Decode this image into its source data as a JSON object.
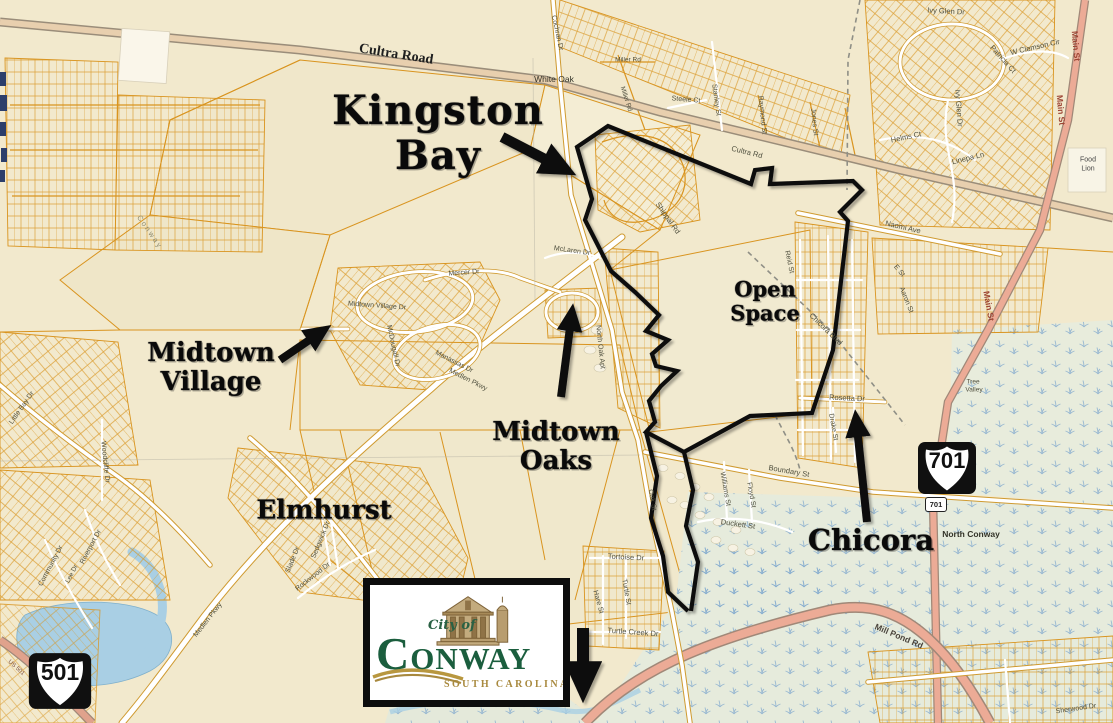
{
  "annotations": {
    "kingston_bay": [
      "Kingston",
      "Bay"
    ],
    "midtown_village": [
      "Midtown",
      "Village"
    ],
    "midtown_oaks": [
      "Midtown",
      "Oaks"
    ],
    "elmhurst": [
      "Elmhurst"
    ],
    "open_space": [
      "Open",
      "Space"
    ],
    "chicora": [
      "Chicora"
    ]
  },
  "shields": {
    "us501": "501",
    "us701": "701"
  },
  "logo": {
    "prefix": "City of",
    "city_initial": "C",
    "city_rest": "ONWAY",
    "state": "SOUTH CAROLINA"
  },
  "colors": {
    "background": "#f2e9cd",
    "parcel_line": "#d9941f",
    "road_white": "#ffffff",
    "highway_salmon": "#ecab96",
    "highway_tan": "#e8cfae",
    "water": "#a9cfe4",
    "swamp": "#e5ead9",
    "boundary_black": "#0d0d0d",
    "logo_green": "#1b5e3e",
    "logo_gold": "#a8893e"
  },
  "street_labels": [
    {
      "t": "Cultra Road",
      "x": 396,
      "y": 55,
      "r": 9,
      "s": 14,
      "b": 1,
      "f": 1,
      "c": "#1f1f1f"
    },
    {
      "t": "White Oak",
      "x": 554,
      "y": 79,
      "r": 0,
      "s": 8.5,
      "c": "#333328"
    },
    {
      "t": "Cochran Dr",
      "x": 557,
      "y": 33,
      "r": 78,
      "s": 7
    },
    {
      "t": "Miller Rd",
      "x": 628,
      "y": 60,
      "r": 0,
      "s": 6.5
    },
    {
      "t": "Miller Rd",
      "x": 626,
      "y": 99,
      "r": 72,
      "s": 6.5
    },
    {
      "t": "Steele Ct",
      "x": 686,
      "y": 100,
      "r": 5,
      "s": 7
    },
    {
      "t": "Stanley St",
      "x": 716,
      "y": 100,
      "r": 82,
      "s": 7
    },
    {
      "t": "Raymond St",
      "x": 762,
      "y": 115,
      "r": 84,
      "s": 7
    },
    {
      "t": "Jones St",
      "x": 814,
      "y": 122,
      "r": 84,
      "s": 7
    },
    {
      "t": "Cultra Rd",
      "x": 747,
      "y": 152,
      "r": 14,
      "s": 7.5
    },
    {
      "t": "Helms Ct",
      "x": 906,
      "y": 137,
      "r": -12,
      "s": 7.5
    },
    {
      "t": "Linepa Ln",
      "x": 968,
      "y": 158,
      "r": -14,
      "s": 7.5
    },
    {
      "t": "Ivy Glen Dr",
      "x": 946,
      "y": 11,
      "r": 3,
      "s": 7.5
    },
    {
      "t": "Ivy Glen Dr",
      "x": 959,
      "y": 108,
      "r": 86,
      "s": 7.5
    },
    {
      "t": "W Clemson Cir",
      "x": 1035,
      "y": 47,
      "r": -13,
      "s": 7.5
    },
    {
      "t": "Patricia Ct",
      "x": 1003,
      "y": 59,
      "r": 48,
      "s": 7.5
    },
    {
      "t": "Main St",
      "x": 1061,
      "y": 110,
      "r": 85,
      "s": 8.5,
      "b": 1,
      "c": "#9c4434"
    },
    {
      "t": "Main St",
      "x": 1076,
      "y": 46,
      "r": 85,
      "s": 8.5,
      "b": 1,
      "c": "#9c4434"
    },
    {
      "t": "Main St",
      "x": 989,
      "y": 306,
      "r": 80,
      "s": 8.5,
      "b": 1,
      "c": "#9c4434"
    },
    {
      "t": "Food",
      "x": 1088,
      "y": 160,
      "r": 0,
      "s": 7,
      "c": "#444444"
    },
    {
      "t": "Lion",
      "x": 1088,
      "y": 169,
      "r": 0,
      "s": 7,
      "c": "#444444"
    },
    {
      "t": "Naomi Ave",
      "x": 903,
      "y": 227,
      "r": 13,
      "s": 7.5
    },
    {
      "t": "Reid St",
      "x": 789,
      "y": 262,
      "r": 78,
      "s": 7
    },
    {
      "t": "E St",
      "x": 899,
      "y": 271,
      "r": 50,
      "s": 7
    },
    {
      "t": "Aaron St",
      "x": 906,
      "y": 300,
      "r": 68,
      "s": 7
    },
    {
      "t": "Chicora Blvd",
      "x": 826,
      "y": 329,
      "r": 44,
      "s": 7.5
    },
    {
      "t": "Shippal Rd",
      "x": 668,
      "y": 218,
      "r": 55,
      "s": 7.5
    },
    {
      "t": "Rosetta Dr",
      "x": 847,
      "y": 398,
      "r": 3,
      "s": 7.5
    },
    {
      "t": "Drake St",
      "x": 833,
      "y": 427,
      "r": 80,
      "s": 7
    },
    {
      "t": "Boundary St",
      "x": 789,
      "y": 471,
      "r": 10,
      "s": 7.5
    },
    {
      "t": "Williams St",
      "x": 725,
      "y": 489,
      "r": 80,
      "s": 7
    },
    {
      "t": "Floyd St",
      "x": 751,
      "y": 495,
      "r": 80,
      "s": 7
    },
    {
      "t": "Duckett St",
      "x": 738,
      "y": 524,
      "r": 8,
      "s": 7.5
    },
    {
      "t": "Oak St",
      "x": 652,
      "y": 500,
      "r": 80,
      "s": 7
    },
    {
      "t": "Tortoise Dr",
      "x": 626,
      "y": 557,
      "r": 3,
      "s": 7.5
    },
    {
      "t": "Turtle St",
      "x": 626,
      "y": 592,
      "r": 80,
      "s": 7
    },
    {
      "t": "Hare St",
      "x": 598,
      "y": 602,
      "r": 74,
      "s": 7
    },
    {
      "t": "Turtle Creek Dr",
      "x": 633,
      "y": 632,
      "r": 4,
      "s": 7.5
    },
    {
      "t": "North Conway",
      "x": 971,
      "y": 534,
      "r": 0,
      "s": 8.5,
      "b": 1,
      "c": "#333328"
    },
    {
      "t": "Tree",
      "x": 973,
      "y": 382,
      "r": 0,
      "s": 6.5
    },
    {
      "t": "Valley",
      "x": 974,
      "y": 390,
      "r": 0,
      "s": 6.5
    },
    {
      "t": "Mill Pond Rd",
      "x": 899,
      "y": 636,
      "r": 23,
      "s": 8.5,
      "b": 1,
      "c": "#4a443c"
    },
    {
      "t": "Mercer Dr",
      "x": 464,
      "y": 273,
      "r": -4,
      "s": 7
    },
    {
      "t": "Midtown Village Dr",
      "x": 377,
      "y": 306,
      "r": 4,
      "s": 7
    },
    {
      "t": "McDougall Dr",
      "x": 393,
      "y": 346,
      "r": 78,
      "s": 7
    },
    {
      "t": "Manassas Dr",
      "x": 454,
      "y": 362,
      "r": 27,
      "s": 7
    },
    {
      "t": "Medlen Pkwy",
      "x": 468,
      "y": 380,
      "r": 27,
      "s": 7
    },
    {
      "t": "Medlen Pkwy",
      "x": 208,
      "y": 620,
      "r": -52,
      "s": 7
    },
    {
      "t": "McLaren Dr",
      "x": 572,
      "y": 251,
      "r": 8,
      "s": 7
    },
    {
      "t": "North Oak Apt",
      "x": 600,
      "y": 347,
      "r": 84,
      "s": 7
    },
    {
      "t": "Little Bay Dr",
      "x": 22,
      "y": 408,
      "r": -55,
      "s": 7
    },
    {
      "t": "Woodcliffe Dr",
      "x": 105,
      "y": 462,
      "r": 84,
      "s": 7
    },
    {
      "t": "Riverport Dr",
      "x": 91,
      "y": 547,
      "r": -62,
      "s": 7
    },
    {
      "t": "Community Dr",
      "x": 51,
      "y": 566,
      "r": -62,
      "s": 7
    },
    {
      "t": "Lee Dr",
      "x": 72,
      "y": 574,
      "r": -62,
      "s": 6.5
    },
    {
      "t": "Rockwood Dr",
      "x": 313,
      "y": 577,
      "r": -38,
      "s": 7
    },
    {
      "t": "Sedgwick Dr",
      "x": 321,
      "y": 540,
      "r": -68,
      "s": 7
    },
    {
      "t": "Slade Dr",
      "x": 293,
      "y": 560,
      "r": -68,
      "s": 7
    },
    {
      "t": "Conway",
      "x": 150,
      "y": 232,
      "r": 55,
      "s": 7.5,
      "c": "#8e8c72",
      "ls": 2
    },
    {
      "t": "US 501",
      "x": 16,
      "y": 668,
      "r": 42,
      "s": 6,
      "c": "#7c5040"
    },
    {
      "t": "Sherwood Dr",
      "x": 1076,
      "y": 709,
      "r": -8,
      "s": 7
    }
  ]
}
